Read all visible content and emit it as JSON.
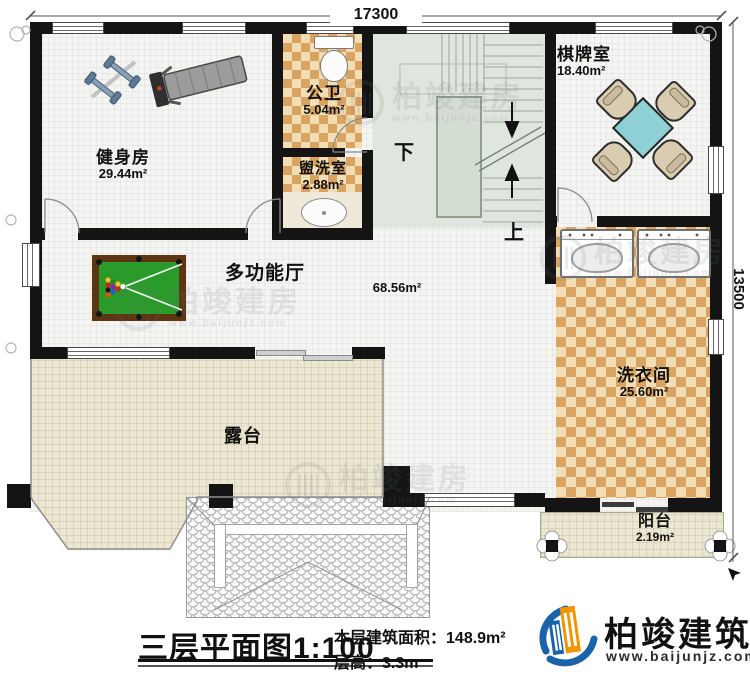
{
  "plan": {
    "dimension_top": "17300",
    "dimension_right": "13500",
    "rooms": {
      "gym": {
        "name": "健身房",
        "area": "29.44m²"
      },
      "public_bathroom": {
        "name": "公卫",
        "area": "5.04m²"
      },
      "washroom": {
        "name": "盥洗室",
        "area": "2.88m²"
      },
      "chess_room": {
        "name": "棋牌室",
        "area": "18.40m²"
      },
      "multi_hall": {
        "name": "多功能厅",
        "area": "68.56m²"
      },
      "laundry": {
        "name": "洗衣间",
        "area": "25.60m²"
      },
      "terrace": {
        "name": "露台"
      },
      "balcony": {
        "name": "阳台",
        "area": "2.19m²"
      }
    },
    "stairs": {
      "down_label": "下",
      "up_label": "上"
    }
  },
  "footer": {
    "plan_title": "三层平面图",
    "scale": "1:100",
    "floor_area_label": "本层建筑面积：",
    "floor_area_value": "148.9m²",
    "floor_height_label": "层高：",
    "floor_height_value": "3.3m"
  },
  "brand": {
    "name": "柏竣建筑",
    "website": "www.baijunjz.com"
  },
  "watermark": {
    "text": "柏竣建房",
    "sub": "www.baijunjz.com"
  },
  "colors": {
    "wall": "#141414",
    "tile_accent": "#d9a361",
    "stair_floor": "#dfe6dd",
    "outdoor_floor": "#ebe7d2",
    "pool_table_green": "#2a9a2b",
    "chess_table_teal": "#8ed0d3",
    "brand_blue": "#1a63a8",
    "brand_orange": "#f29600"
  }
}
